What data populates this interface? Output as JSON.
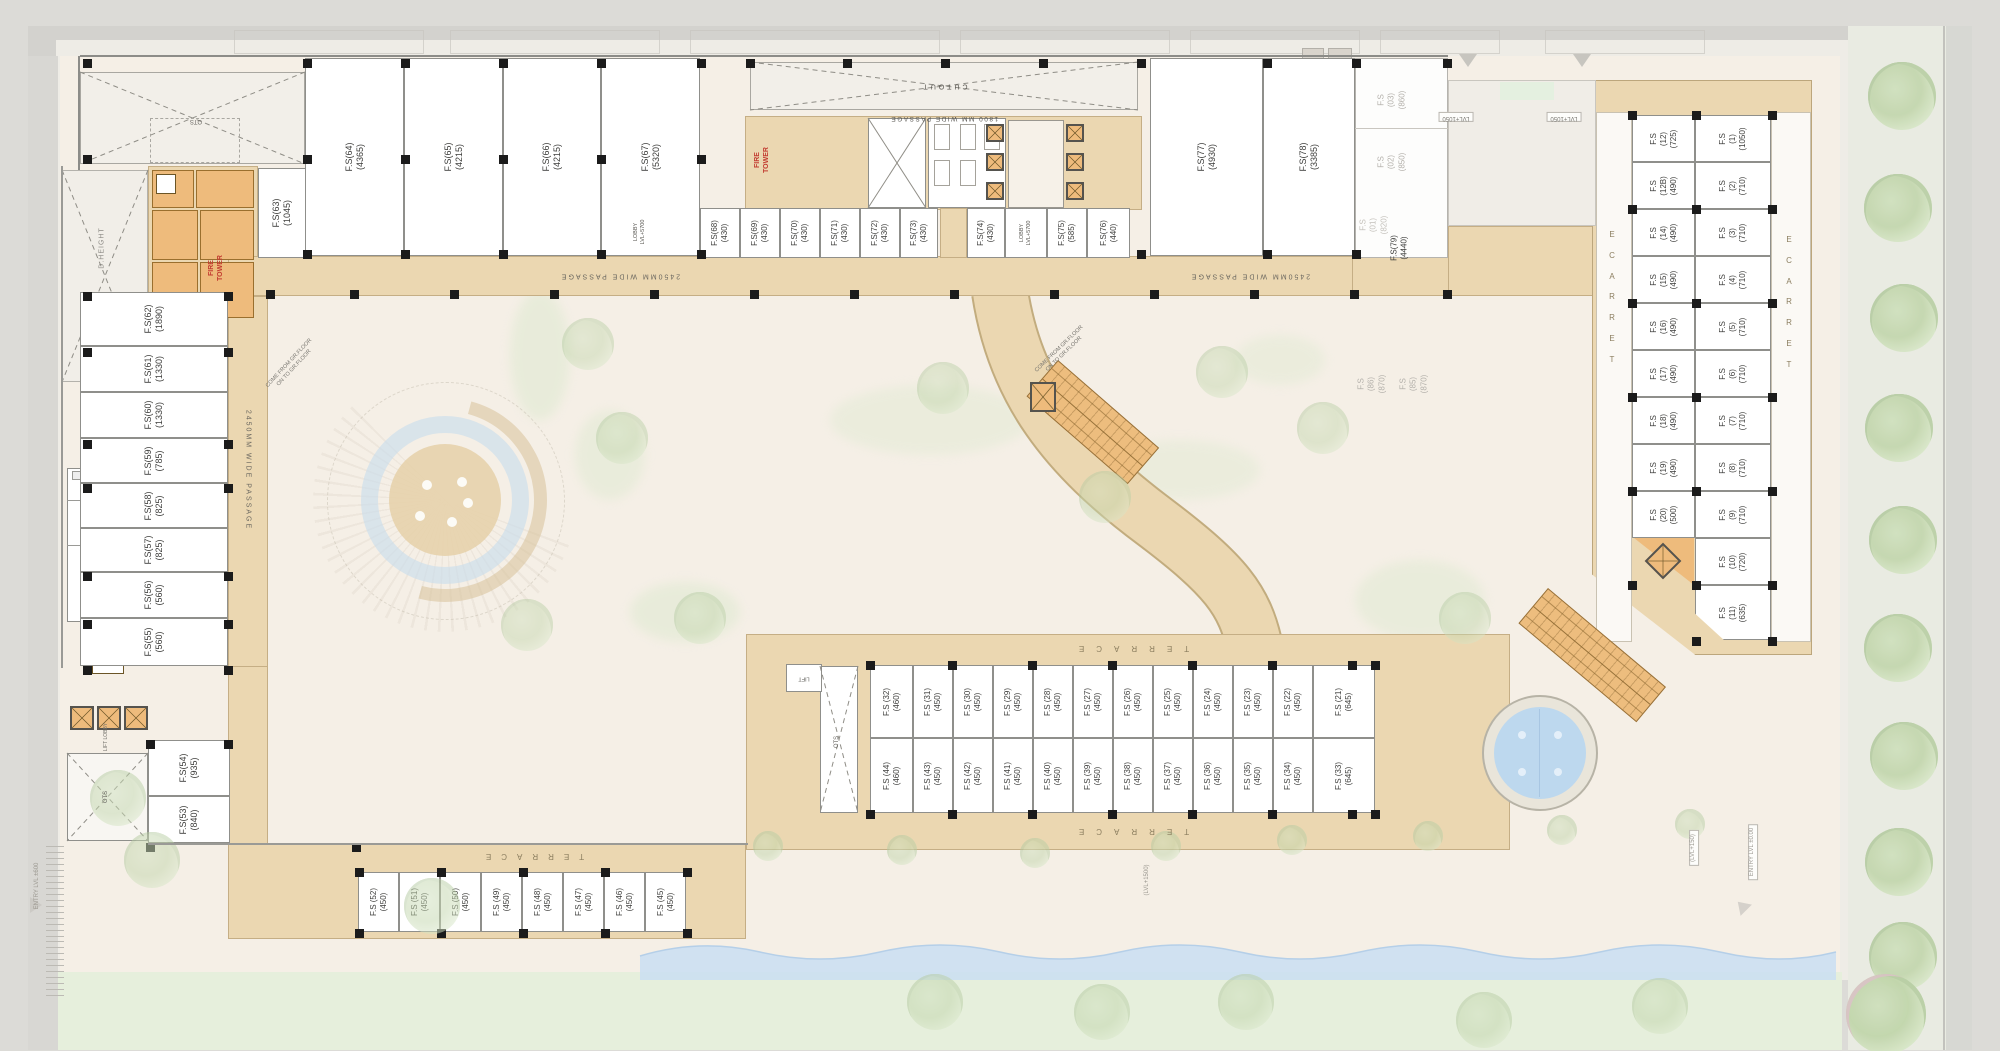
{
  "zones": {
    "top_large": [
      "F.S(64)\n(4365)",
      "F.S(65)\n(4215)",
      "F.S(66)\n(4215)",
      "F.S(67)\n(5320)"
    ],
    "top_small": [
      "F.S(68)\n(430)",
      "F.S(69)\n(430)",
      "F.S(70)\n(430)",
      "F.S(71)\n(430)",
      "F.S(72)\n(430)",
      "F.S(73)\n(430)",
      "F.S(74)\n(430)",
      "F.S(75)\n(585)",
      "F.S(76)\n(440)"
    ],
    "top_right": [
      "F.S(77)\n(4930)",
      "F.S(78)\n(3385)"
    ],
    "fs63": "F.S(63)\n(1045)",
    "fs79": "F.S(79)\n(4440)",
    "left_col": [
      "F.S(62)\n(1890)",
      "F.S(61)\n(1330)",
      "F.S(60)\n(1330)",
      "F.S(59)\n(785)",
      "F.S(58)\n(825)",
      "F.S(57)\n(825)",
      "F.S(56)\n(560)",
      "F.S(55)\n(560)",
      "F.S(54)\n(935)",
      "F.S(53)\n(840)"
    ],
    "right_inner": [
      "F.S\n(12)\n(725)",
      "F.S\n(12B)\n(490)",
      "F.S\n(14)\n(490)",
      "F.S\n(15)\n(490)",
      "F.S\n(16)\n(490)",
      "F.S\n(17)\n(490)",
      "F.S\n(18)\n(490)",
      "F.S\n(19)\n(490)",
      "F.S\n(20)\n(500)"
    ],
    "right_outer": [
      "F.S\n(1)\n(1050)",
      "F.S\n(2)\n(710)",
      "F.S\n(3)\n(710)",
      "F.S\n(4)\n(710)",
      "F.S\n(5)\n(710)",
      "F.S\n(6)\n(710)",
      "F.S\n(7)\n(710)",
      "F.S\n(8)\n(710)",
      "F.S\n(9)\n(710)",
      "F.S\n(10)\n(720)",
      "F.S\n(11)\n(635)"
    ],
    "mid_top": [
      "F.S (32)\n(460)",
      "F.S (31)\n(450)",
      "F.S (30)\n(450)",
      "F.S (29)\n(450)",
      "F.S (28)\n(450)",
      "F.S (27)\n(450)",
      "F.S (26)\n(450)",
      "F.S (25)\n(450)",
      "F.S (24)\n(450)",
      "F.S (23)\n(450)",
      "F.S (22)\n(450)",
      "F.S (21)\n(645)"
    ],
    "mid_bottom": [
      "F.S (44)\n(460)",
      "F.S (43)\n(450)",
      "F.S (42)\n(450)",
      "F.S (41)\n(450)",
      "F.S (40)\n(450)",
      "F.S (39)\n(450)",
      "F.S (38)\n(450)",
      "F.S (37)\n(450)",
      "F.S (36)\n(450)",
      "F.S (35)\n(450)",
      "F.S (34)\n(450)",
      "F.S (33)\n(645)"
    ],
    "bottom_row": [
      "F.S (52)\n(450)",
      "F.S (51)\n(450)",
      "F.S (50)\n(450)",
      "F.S (49)\n(450)",
      "F.S (48)\n(450)",
      "F.S (47)\n(450)",
      "F.S (46)\n(450)",
      "F.S (45)\n(450)"
    ],
    "ghosts": [
      "F.S\n(03)\n(860)",
      "F.S\n(02)\n(850)",
      "F.S\n(01)\n(820)",
      "F.S\n(86)\n(870)",
      "F.S\n(85)\n(870)"
    ]
  },
  "labels": {
    "cutout": "CUTOUT",
    "passage_1800": "1800 MM WIDE PASSAGE",
    "passage_2450": "2450MM WIDE PASSAGE",
    "terrace": "TERRACE",
    "d_height": "D.HEIGHT",
    "ots": "OTS",
    "fire_tower": "FIRE\nTOWER",
    "lobby_5700": "LOBBY\nLVL+5700",
    "lvl_1050": "LVL+1050",
    "lift": "LIFT",
    "lift_lobby": "LIFT LOBBY",
    "come_from": "COME FROM GR.FLOOR\nON TO GR.FLOOR",
    "lvl_1500": "(LVL+1500)",
    "lvl_150": "(LVL+150)",
    "entry_lvl_0": "ENTRY LVL ±0.00",
    "entry_lvl_600": "ENTRY LVL ±600"
  },
  "colors": {
    "corridor_tan": "#ebd7b1",
    "core_orange": "#eebb7c",
    "plaza": "#f5efe6",
    "lawn_green": "#e6efdc",
    "stream_blue": "#c9def2",
    "pool_blue": "#bdd8ee",
    "column_black": "#1b1b1b",
    "fire_red": "#c23b30",
    "ghost_gray": "#b3b0aa"
  }
}
